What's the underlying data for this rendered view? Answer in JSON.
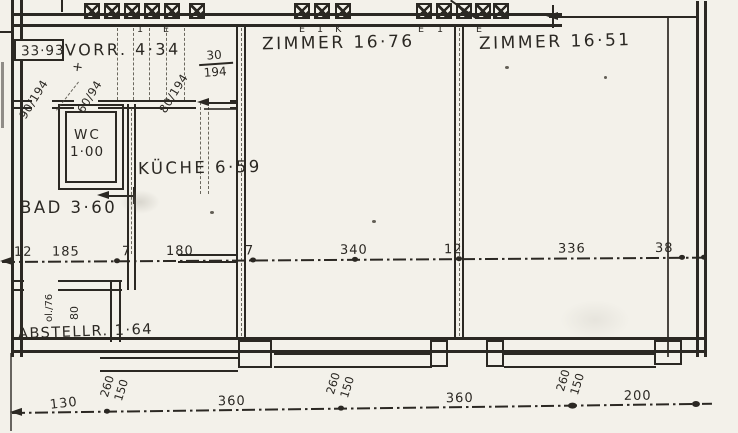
{
  "summary": {
    "total": "33·93"
  },
  "rooms": {
    "vorr": "VORR. 4·34",
    "zimmer_a": "ZIMMER 16·76",
    "zimmer_b": "ZIMMER 16·51",
    "wc_name": "WC",
    "wc_area": "1·00",
    "kueche": "KÜCHE 6·59",
    "bad": "BAD 3·60",
    "abstell": "ABSTELLR. 1·64"
  },
  "flue_labels": {
    "g1a": "1",
    "g1b": "E",
    "g2": "E 1 K",
    "g3": "E 1",
    "g4": "E"
  },
  "window_size": {
    "num": "30",
    "den": "194"
  },
  "annotations": {
    "door_a": "90/194",
    "door_b": "60/94",
    "door_c": "80/194",
    "abstell_v1": "ol./76",
    "abstell_v2": "80",
    "plus": "+"
  },
  "mid_dims": [
    "12",
    "185",
    "7",
    "180",
    "7",
    "340",
    "12",
    "336",
    "38"
  ],
  "bottom_dims": [
    "130",
    "260",
    "150",
    "360",
    "260",
    "150",
    "360",
    "260",
    "150",
    "200"
  ]
}
